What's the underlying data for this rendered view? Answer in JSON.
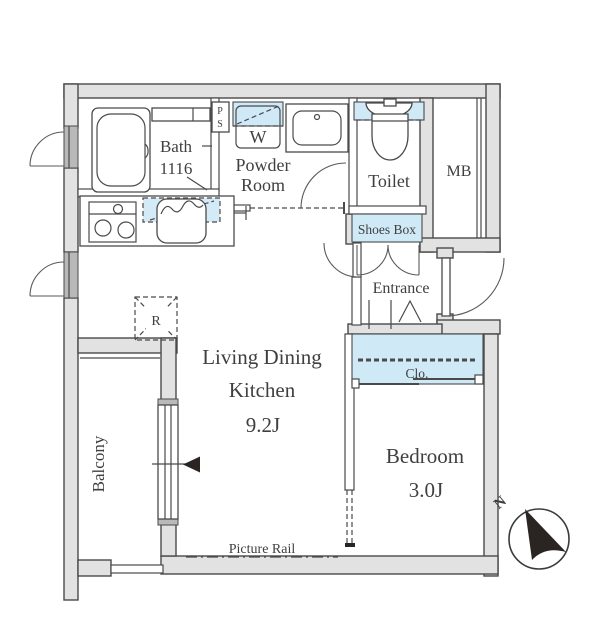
{
  "colors": {
    "fixture_blue": "#cfe9f6",
    "wall_fill": "#e2e2e2",
    "line": "#4a4a4a",
    "text": "#3f3f3f",
    "compass_needle": "#2a2523"
  },
  "rooms": {
    "bath": {
      "label": "Bath",
      "size": "1116"
    },
    "powder_room": {
      "label_line1": "Powder",
      "label_line2": "Room"
    },
    "toilet": {
      "label": "Toilet"
    },
    "meter_box": {
      "label": "MB"
    },
    "shoes_box": {
      "label": "Shoes Box"
    },
    "entrance": {
      "label": "Entrance"
    },
    "closet": {
      "label": "Clo."
    },
    "ldk": {
      "label_line1": "Living Dining",
      "label_line2": "Kitchen",
      "size": "9.2J"
    },
    "bedroom": {
      "label": "Bedroom",
      "size": "3.0J"
    },
    "balcony": {
      "label": "Balcony"
    }
  },
  "fixtures": {
    "washing_machine": "W",
    "pipe_space_top": "P",
    "pipe_space_bottom": "S",
    "refrigerator": "R"
  },
  "annotations": {
    "picture_rail": "Picture Rail",
    "compass_north": "N"
  }
}
